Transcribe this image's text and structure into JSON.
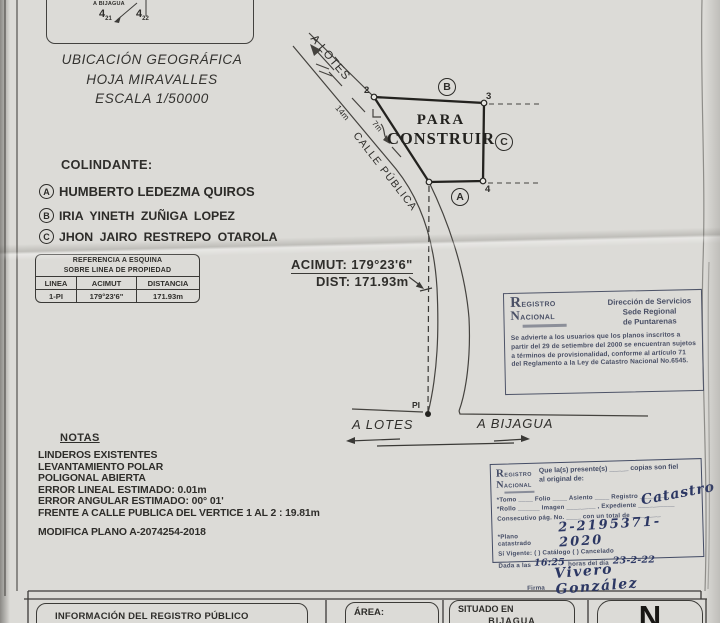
{
  "colors": {
    "paper": "#dcdbd7",
    "ink": "#2e2d2a",
    "stamp_ink": "#4a5066",
    "pen_ink": "#2c3763"
  },
  "photo": {
    "sketch": {
      "to_bijagua": "A BIJAGUA",
      "grid1_main": "4",
      "grid1_sub": "21",
      "grid2_main": "4",
      "grid2_sub": "22"
    },
    "ubicacion": {
      "line1": "UBICACIÓN GEOGRÁFICA",
      "line2": "HOJA MIRAVALLES",
      "line3": "ESCALA 1/50000"
    },
    "colindante": {
      "title": "COLINDANTE:",
      "items": [
        {
          "key": "A",
          "name": "HUMBERTO LEDEZMA QUIROS"
        },
        {
          "key": "B",
          "name": "IRIA YINETH ZUÑIGA LOPEZ"
        },
        {
          "key": "C",
          "name": "JHON JAIRO RESTREPO OTAROLA"
        }
      ]
    },
    "ref_table": {
      "title1": "REFERENCIA A ESQUINA",
      "title2": "SOBRE LINEA DE PROPIEDAD",
      "headers": [
        "LINEA",
        "ACIMUT",
        "DISTANCIA"
      ],
      "row": [
        "1-PI",
        "179°23'6\"",
        "171.93m"
      ]
    },
    "plan": {
      "a_lotes_road": "A LOTES",
      "road_width": "14m",
      "calle": "CALLE PÚBLICA",
      "offset": "7m",
      "para": "PARA",
      "construir": "CONSTRUIR",
      "v2": "2",
      "v3": "3",
      "v4": "4",
      "nb_a": "A",
      "nb_b": "B",
      "nb_c": "C",
      "acimut": "ACIMUT: 179°23'6\"",
      "dist": "DIST: 171.93m",
      "pi": "PI",
      "a_lotes": "A LOTES",
      "a_bijagua": "A BIJAGUA"
    },
    "stamp_regional": {
      "logo_r": "R",
      "logo_registro": "EGISTRO",
      "logo_n": "N",
      "logo_nacional": "ACIONAL",
      "dir1": "Dirección de Servicios",
      "dir2": "Sede Regional",
      "dir3": "de Puntarenas",
      "body": "Se advierte a los usuarios que los planos inscritos a partir del 29 de setiembre del 2000 se encuentran sujetos a términos de provisionalidad, conforme al artículo 71 del Reglamento a la Ley de Catastro Nacional No.6545."
    },
    "notas": {
      "title": "NOTAS",
      "lines": [
        "LINDEROS EXISTENTES",
        "LEVANTAMIENTO POLAR",
        "POLIGONAL ABIERTA",
        "ERROR LINEAL ESTIMADO: 0.01m",
        "ERROR ANGULAR ESTIMADO: 00° 01'",
        "FRENTE A CALLE PUBLICA DEL VERTICE 1 AL 2 : 19.81m"
      ],
      "modifica": "MODIFICA PLANO A-2074254-2018"
    },
    "stamp_cert": {
      "logo_r": "R",
      "logo_registro": "EGISTRO",
      "logo_n": "N",
      "logo_nacional": "ACIONAL",
      "intro1": "Que la(s) presente(s) _____ copias son fiel",
      "intro2": "al original de:",
      "row_tomo": "*Tomo ____  Folio ____  Asiento ____  Registro ________",
      "hand_registro": "Catastro",
      "row_rollo": "*Rollo ______  Imagen ________ , Expediente __________",
      "row_consecutivo": "Consecutivo pág. No. ____  con un total de ________",
      "row_plano": "*Plano catastrado",
      "hand_plano": "2-2195371-2020",
      "row_vigente": "Sí Vigente:  (  ) Catálogo  (  ) Cancelado",
      "dada1": "Dada a las",
      "hand_hora": "16:25",
      "dada2": "horas del día",
      "hand_fecha": "23-2-22",
      "firma_label": "Firma",
      "hand_firma": "Vivero González"
    },
    "footer": {
      "info": "INFORMACIÓN DEL REGISTRO PÚBLICO",
      "area": "ÁREA:",
      "situado1": "SITUADO EN",
      "situado2": "BIJAGUA",
      "north": "N"
    }
  }
}
